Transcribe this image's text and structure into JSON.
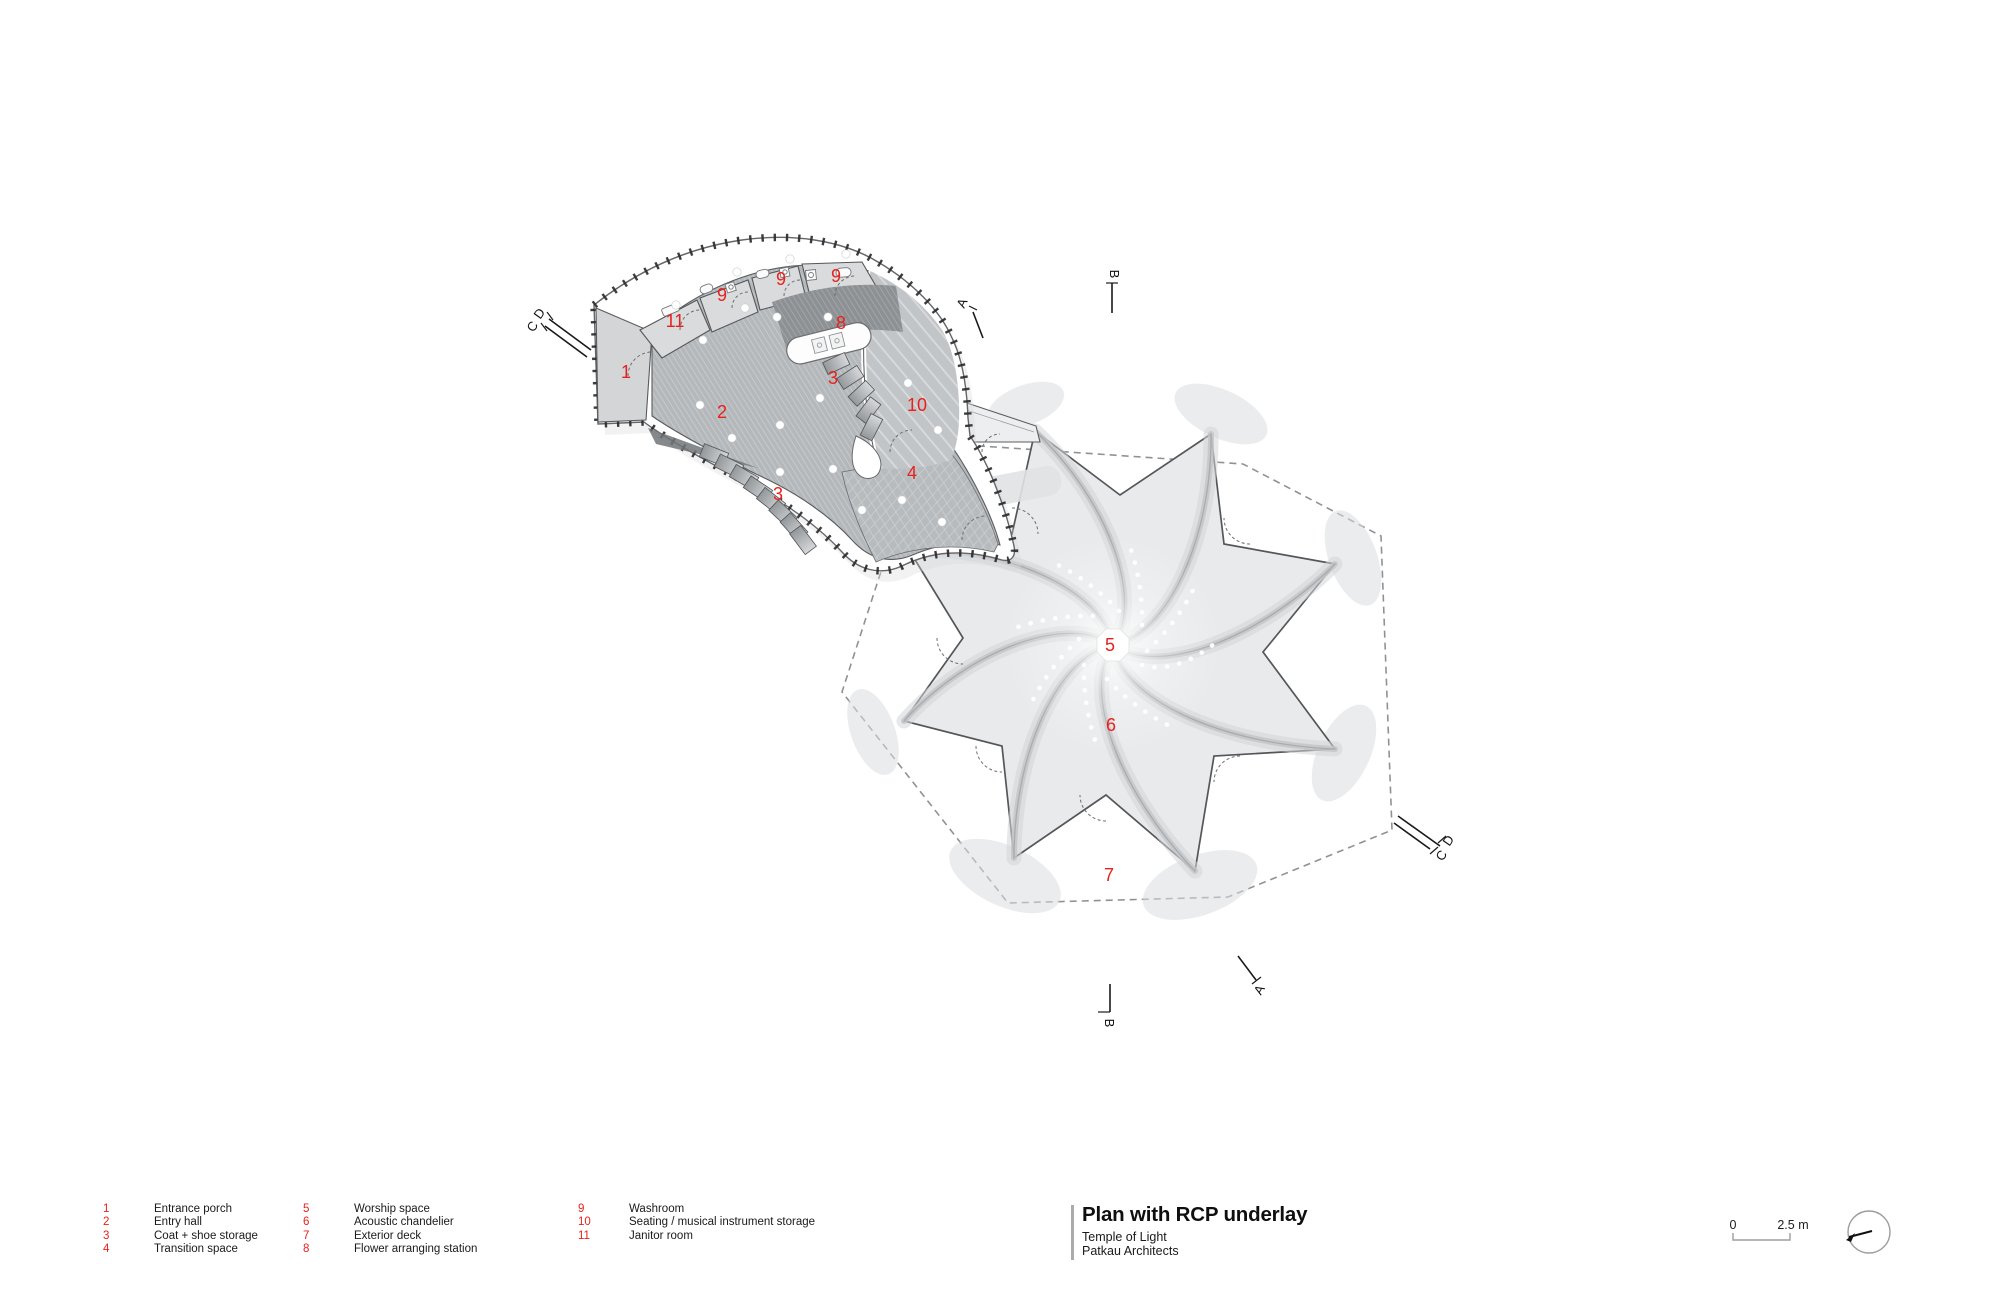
{
  "header": {
    "title": "Plan with RCP underlay",
    "project": "Temple of Light",
    "architect": "Patkau Architects"
  },
  "legend": {
    "columns": [
      {
        "items": [
          {
            "num": "1",
            "label": "Entrance porch"
          },
          {
            "num": "2",
            "label": "Entry hall"
          },
          {
            "num": "3",
            "label": "Coat + shoe storage"
          },
          {
            "num": "4",
            "label": "Transition space"
          }
        ]
      },
      {
        "items": [
          {
            "num": "5",
            "label": "Worship space"
          },
          {
            "num": "6",
            "label": "Acoustic chandelier"
          },
          {
            "num": "7",
            "label": "Exterior deck"
          },
          {
            "num": "8",
            "label": "Flower arranging station"
          }
        ]
      },
      {
        "items": [
          {
            "num": "9",
            "label": "Washroom"
          },
          {
            "num": "10",
            "label": "Seating / musical instrument storage"
          },
          {
            "num": "11",
            "label": "Janitor room"
          }
        ]
      }
    ]
  },
  "plan_labels": [
    {
      "text": "1"
    },
    {
      "text": "2"
    },
    {
      "text": "3"
    },
    {
      "text": "3"
    },
    {
      "text": "4"
    },
    {
      "text": "5"
    },
    {
      "text": "6"
    },
    {
      "text": "7"
    },
    {
      "text": "8"
    },
    {
      "text": "9"
    },
    {
      "text": "9"
    },
    {
      "text": "9"
    },
    {
      "text": "10"
    },
    {
      "text": "11"
    }
  ],
  "section_markers": {
    "a_top": "A",
    "b_top": "B",
    "a_bottom": "A",
    "b_bottom": "B",
    "d_left": "D",
    "c_left": "C",
    "d_right": "D",
    "c_right": "C"
  },
  "scale_bar": {
    "zero": "0",
    "max": "2.5 m"
  },
  "colors": {
    "label_red": "#e8211d"
  }
}
